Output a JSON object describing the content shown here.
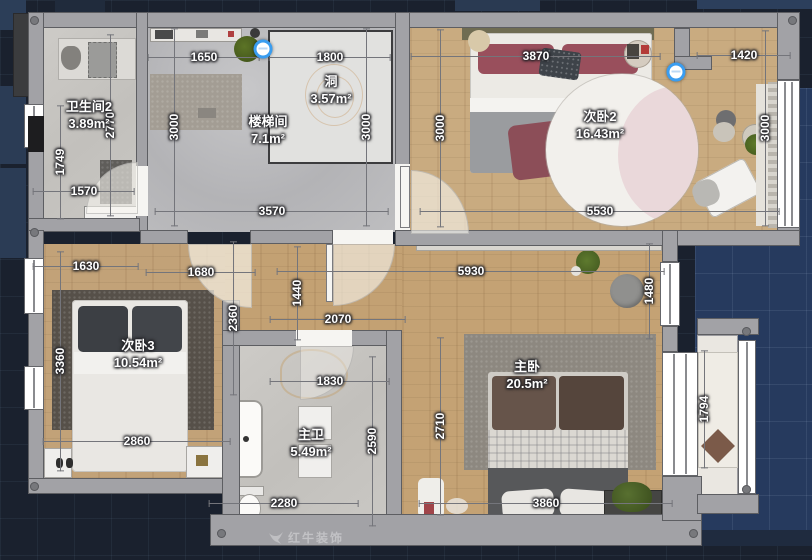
{
  "app": {
    "watermark": "红牛装饰"
  },
  "colors": {
    "canvas_background": "#1a212e",
    "outer_area_panel": "#263a5e",
    "wall": "#a2a2a6",
    "wood_floor": "#c6a77b",
    "tile_floor": "#c8c6c2",
    "selection_marker_accent": "#3a9df0",
    "dimension_text": "#ffffff"
  },
  "rooms": [
    {
      "id": "bathroom2",
      "name": "卫生间2",
      "area": "3.89m²",
      "x": 89,
      "y": 116
    },
    {
      "id": "stairwell",
      "name": "楼梯间",
      "area": "7.1m²",
      "x": 268,
      "y": 131
    },
    {
      "id": "hole",
      "name": "洞",
      "area": "3.57m²",
      "x": 331,
      "y": 91
    },
    {
      "id": "bedroom2",
      "name": "次卧2",
      "area": "16.43m²",
      "x": 600,
      "y": 126
    },
    {
      "id": "bedroom3",
      "name": "次卧3",
      "area": "10.54m²",
      "x": 138,
      "y": 355
    },
    {
      "id": "master-bath",
      "name": "主卫",
      "area": "5.49m²",
      "x": 311,
      "y": 444
    },
    {
      "id": "master-bedroom",
      "name": "主卧",
      "area": "20.5m²",
      "x": 527,
      "y": 376
    }
  ],
  "dimensions": [
    {
      "t": "1650",
      "x": 204,
      "y": 57,
      "v": 0,
      "len": 112
    },
    {
      "t": "1800",
      "x": 330,
      "y": 57,
      "v": 0,
      "len": 122
    },
    {
      "t": "3870",
      "x": 536,
      "y": 56,
      "v": 0,
      "len": 250
    },
    {
      "t": "1420",
      "x": 744,
      "y": 55,
      "v": 0,
      "len": 94
    },
    {
      "t": "2770",
      "x": 110,
      "y": 125,
      "v": 1,
      "len": 182
    },
    {
      "t": "3000",
      "x": 174,
      "y": 127,
      "v": 1,
      "len": 198
    },
    {
      "t": "3000",
      "x": 366,
      "y": 127,
      "v": 1,
      "len": 198
    },
    {
      "t": "3000",
      "x": 440,
      "y": 128,
      "v": 1,
      "len": 198
    },
    {
      "t": "3000",
      "x": 765,
      "y": 128,
      "v": 1,
      "len": 196
    },
    {
      "t": "1749",
      "x": 60,
      "y": 162,
      "v": 1,
      "len": 114
    },
    {
      "t": "1570",
      "x": 84,
      "y": 191,
      "v": 0,
      "len": 102
    },
    {
      "t": "3570",
      "x": 272,
      "y": 211,
      "v": 0,
      "len": 234
    },
    {
      "t": "5530",
      "x": 600,
      "y": 211,
      "v": 0,
      "len": 360
    },
    {
      "t": "1630",
      "x": 86,
      "y": 266,
      "v": 0,
      "len": 106
    },
    {
      "t": "1680",
      "x": 201,
      "y": 272,
      "v": 0,
      "len": 110
    },
    {
      "t": "1440",
      "x": 297,
      "y": 293,
      "v": 1,
      "len": 94
    },
    {
      "t": "5930",
      "x": 471,
      "y": 271,
      "v": 0,
      "len": 388
    },
    {
      "t": "1480",
      "x": 649,
      "y": 291,
      "v": 1,
      "len": 96
    },
    {
      "t": "2070",
      "x": 338,
      "y": 319,
      "v": 0,
      "len": 136
    },
    {
      "t": "2360",
      "x": 233,
      "y": 318,
      "v": 1,
      "len": 154
    },
    {
      "t": "3360",
      "x": 60,
      "y": 361,
      "v": 1,
      "len": 220
    },
    {
      "t": "1830",
      "x": 330,
      "y": 381,
      "v": 0,
      "len": 120
    },
    {
      "t": "2590",
      "x": 372,
      "y": 441,
      "v": 1,
      "len": 170
    },
    {
      "t": "2710",
      "x": 440,
      "y": 426,
      "v": 1,
      "len": 178
    },
    {
      "t": "2860",
      "x": 137,
      "y": 441,
      "v": 0,
      "len": 188
    },
    {
      "t": "1794",
      "x": 704,
      "y": 409,
      "v": 1,
      "len": 118
    },
    {
      "t": "2280",
      "x": 284,
      "y": 503,
      "v": 0,
      "len": 150
    },
    {
      "t": "3860",
      "x": 546,
      "y": 503,
      "v": 0,
      "len": 254
    }
  ],
  "markers": [
    {
      "x": 263,
      "y": 49
    },
    {
      "x": 676,
      "y": 72
    }
  ]
}
